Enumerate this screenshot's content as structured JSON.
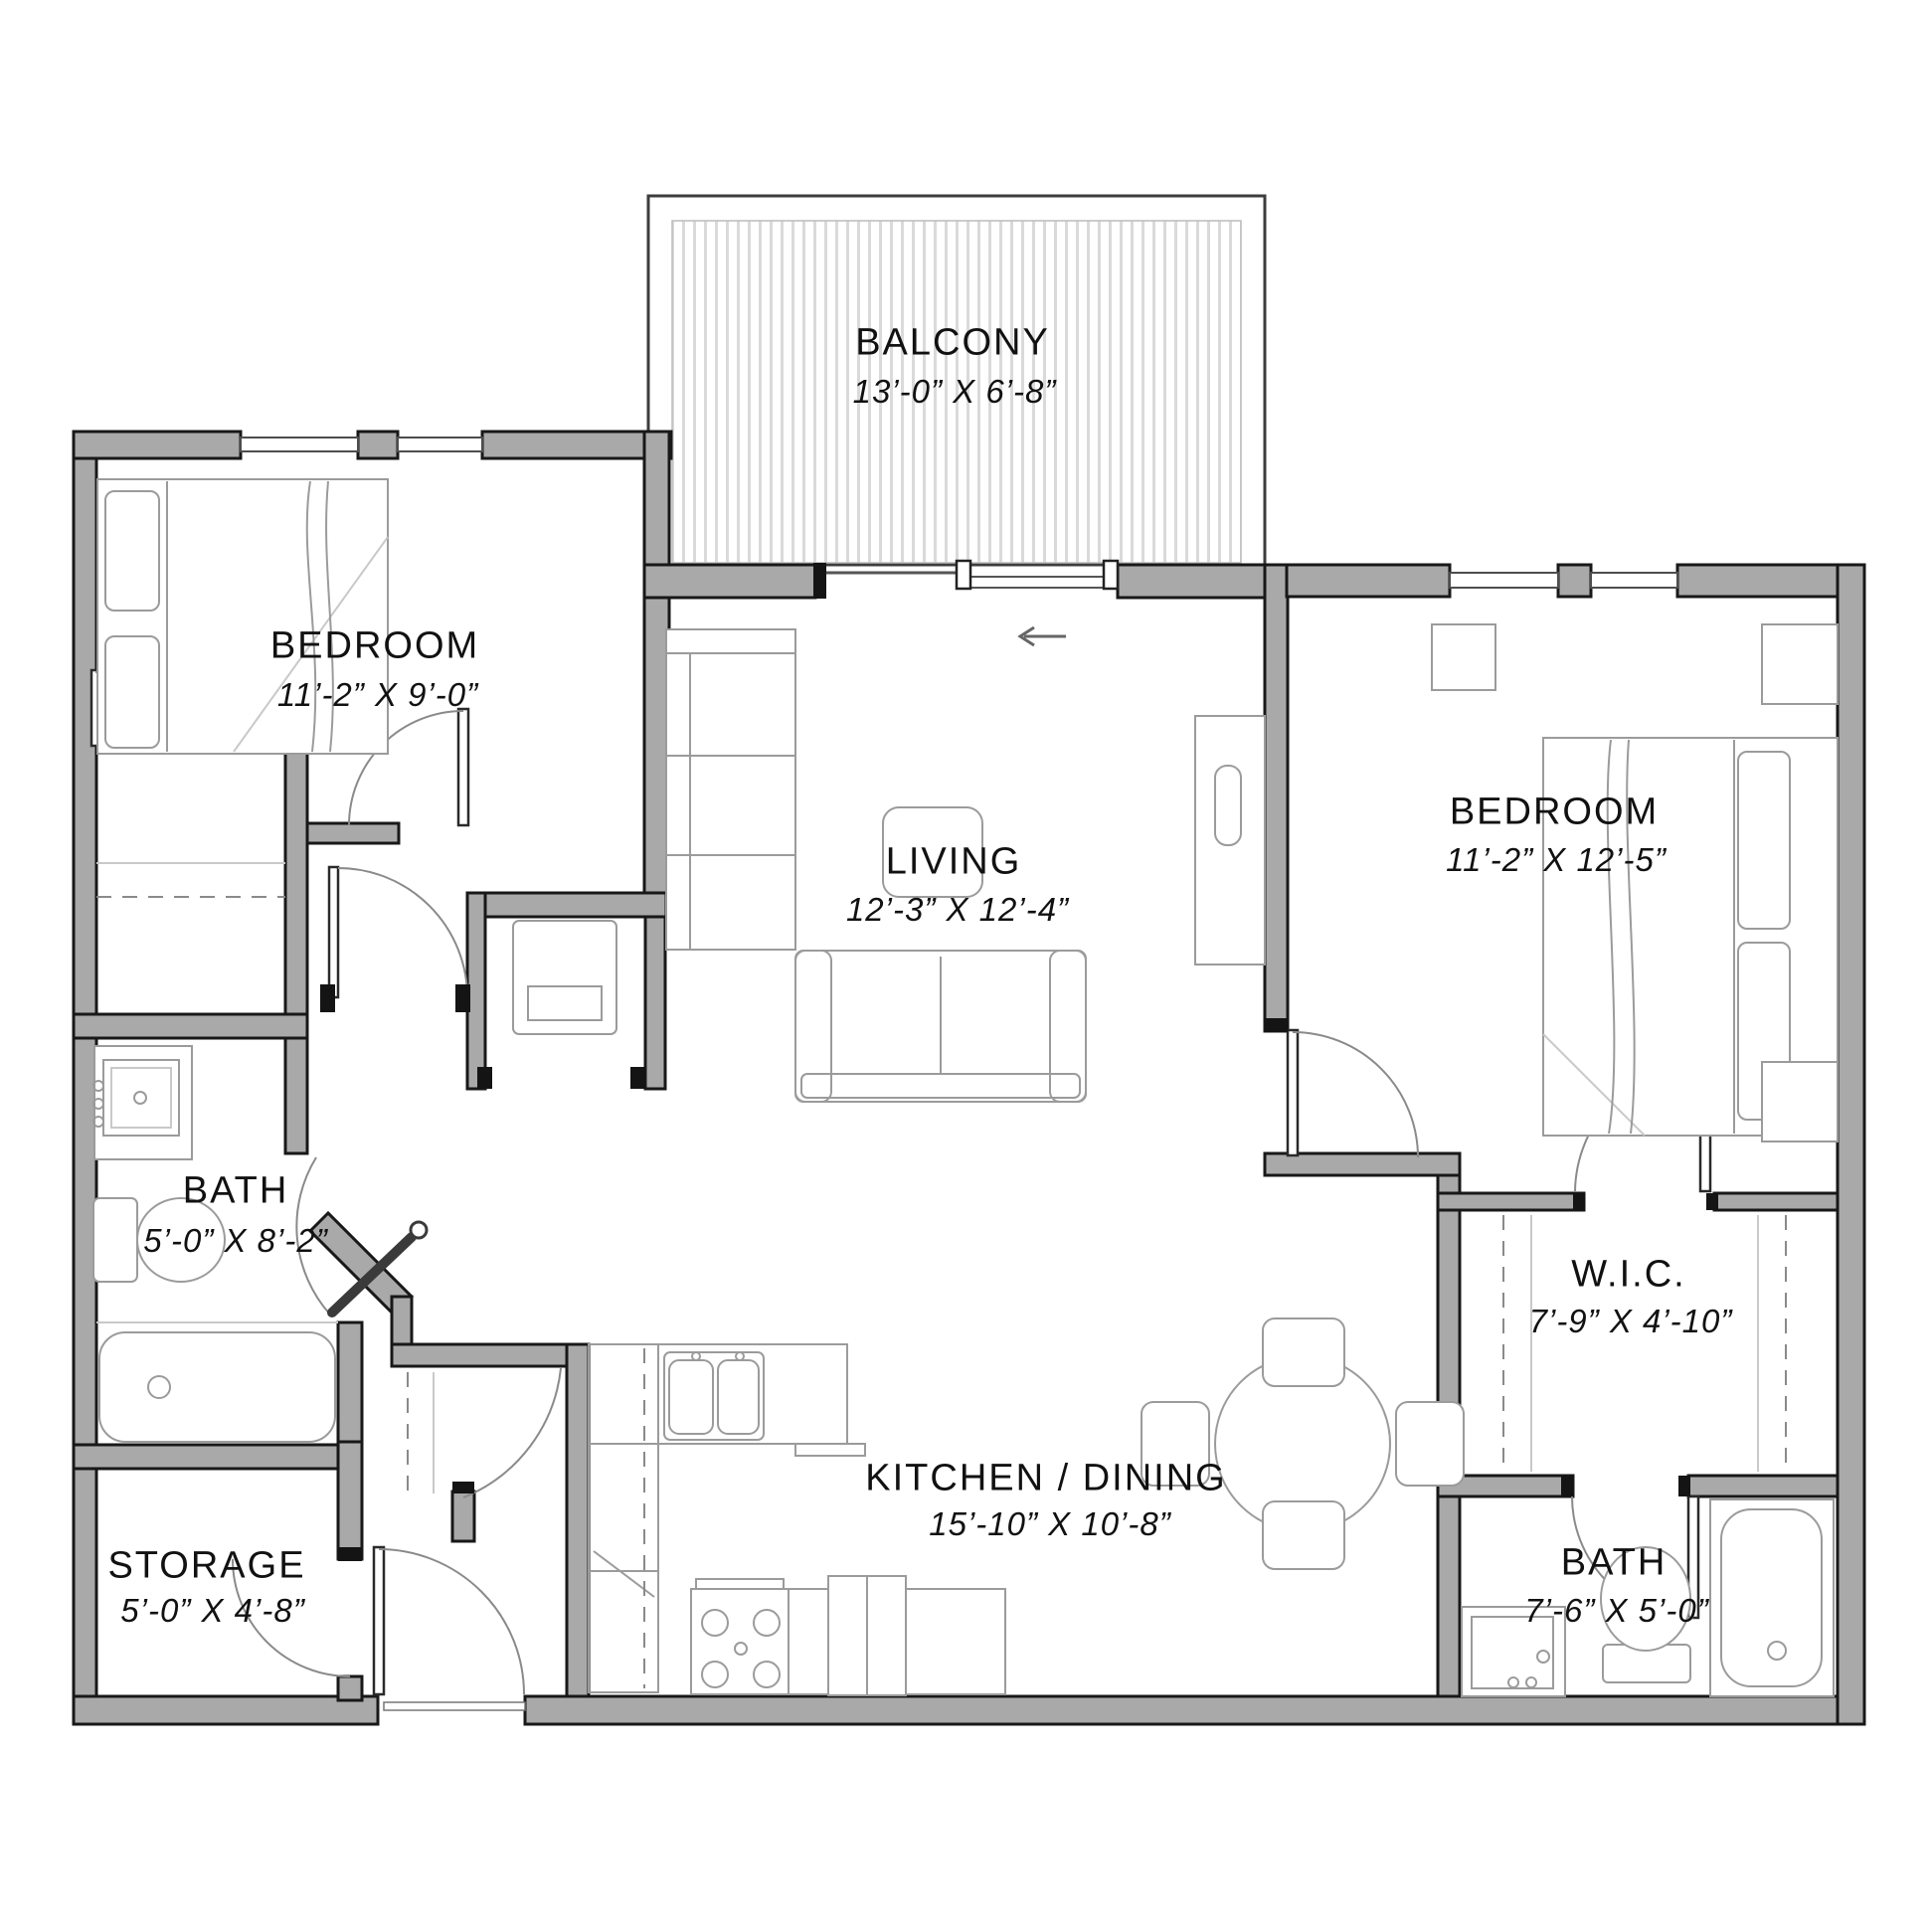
{
  "document": {
    "type": "apartment floor plan",
    "description": "Two-bedroom, two-bath unit floor plan with balcony, living room, kitchen/dining, walk-in closet and storage"
  },
  "colors": {
    "background": "#ffffff",
    "wall_fill": "#a9a9a9",
    "wall_edge": "#181818",
    "fixture_line": "#9b9b9b",
    "deck_stripe": "#dadada",
    "text": "#111111"
  },
  "rooms": [
    {
      "id": "balcony",
      "name": "BALCONY",
      "dims": "13’-0” X 6’-8”"
    },
    {
      "id": "bedroom-1",
      "name": "BEDROOM",
      "dims": "11’-2” X 9’-0”"
    },
    {
      "id": "living",
      "name": "LIVING",
      "dims": "12’-3” X 12’-4”"
    },
    {
      "id": "bedroom-2",
      "name": "BEDROOM",
      "dims": "11’-2” X 12’-5”"
    },
    {
      "id": "bath-1",
      "name": "BATH",
      "dims": "5’-0” X 8’-2”"
    },
    {
      "id": "wic",
      "name": "W.I.C.",
      "dims": "7’-9” X 4’-10”"
    },
    {
      "id": "kitchen-dining",
      "name": "KITCHEN / DINING",
      "dims": "15’-10” X 10’-8”"
    },
    {
      "id": "storage",
      "name": "STORAGE",
      "dims": "5’-0” X 4’-8”"
    },
    {
      "id": "bath-2",
      "name": "BATH",
      "dims": "7’-6” X 5’-0”"
    }
  ]
}
